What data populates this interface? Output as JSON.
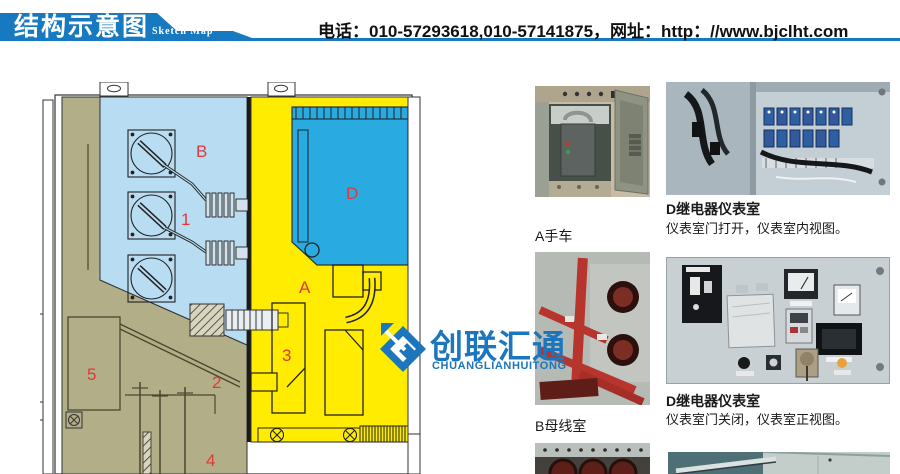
{
  "header": {
    "title": "结构示意图",
    "subtitle": "Sketch Map",
    "contact": "电话：010-57293618,010-57141875，网址：http：//www.bjclht.com"
  },
  "diagram": {
    "zone_labels": [
      {
        "id": "B",
        "text": "B"
      },
      {
        "id": "1",
        "text": "1"
      },
      {
        "id": "D",
        "text": "D"
      },
      {
        "id": "A",
        "text": "A"
      },
      {
        "id": "3",
        "text": "3"
      },
      {
        "id": "2",
        "text": "2"
      },
      {
        "id": "5",
        "text": "5"
      },
      {
        "id": "4",
        "text": "4"
      }
    ],
    "colors": {
      "busbar_room": "#b8dcf2",
      "instrument_room": "#29abe2",
      "breaker_room": "#ffec00",
      "cable_room": "#b2ae87",
      "label_red": "#e0393c"
    }
  },
  "watermark": {
    "cn": "创联汇通",
    "en": "CHUANGLIANHUITONG",
    "color": "#1c76bd"
  },
  "photos": [
    {
      "caption": "A手车"
    },
    {
      "title": "D继电器仪表室",
      "subtitle": "仪表室门打开，仪表室内视图。"
    },
    {
      "caption": "B母线室"
    },
    {
      "title": "D继电器仪表室",
      "subtitle": "仪表室门关闭，仪表室正视图。"
    }
  ],
  "theme": {
    "banner_blue": "#1779c0",
    "watermark_blue": "#1c76bd"
  }
}
